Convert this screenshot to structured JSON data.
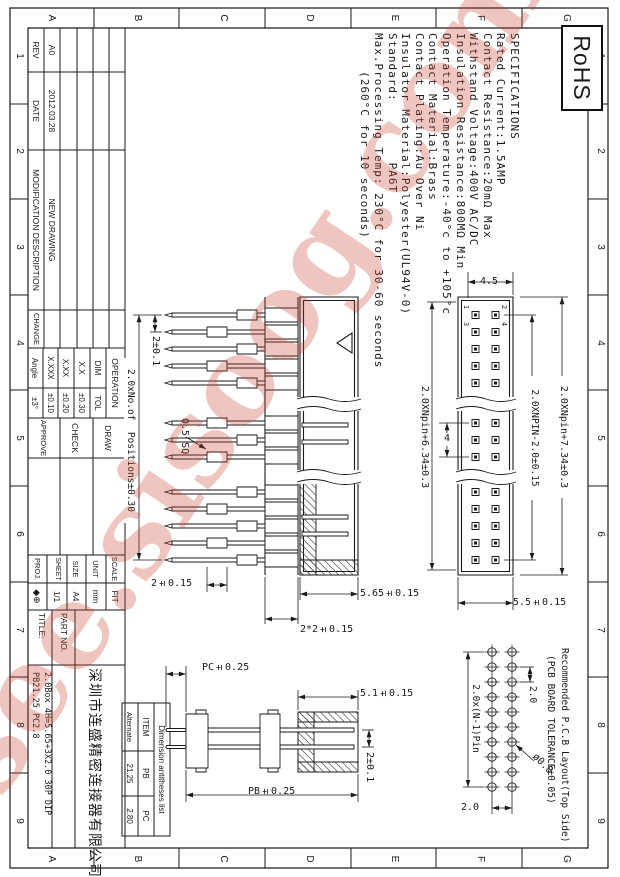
{
  "watermark": {
    "text": "isee.sisoog.com"
  },
  "rohs": {
    "label": "RoHS"
  },
  "frame": {
    "letters": [
      "G",
      "F",
      "E",
      "D",
      "C",
      "B",
      "A"
    ],
    "numbers": [
      "1",
      "2",
      "3",
      "4",
      "5",
      "6",
      "7",
      "8",
      "9"
    ]
  },
  "specs": {
    "lines": [
      "SPECIFICATIONS",
      "Rated Current:1.5AMP",
      "Contact Resistance:20mΩ Max",
      "Withstand Voltage:400V AC/DC",
      "Insulation Resistance:800MΩ Min",
      "Operation Temperature:-40°c to +105°c",
      "Contact Material:Brass",
      "Contact Plating:Au Over Ni",
      "Insulator Material:Polyester(UL94V-0)",
      "Standard:        PA6T",
      "Max.Processing Temp: 230°C for 30-60 seconds",
      "     (260°C for 10 seconds)"
    ]
  },
  "rev_table": {
    "headers": {
      "rev": "REV",
      "date": "DATE",
      "desc": "MODIFICATION  DESCRIPTION",
      "change": "CHANGE"
    },
    "row": {
      "rev": "A0",
      "date": "2012.03.28",
      "desc": "NEW  DRAWING"
    }
  },
  "tol_table": {
    "operation": "OPERATION",
    "dim": "DIM",
    "tol": "TOL",
    "rows": [
      {
        "d": "X.X",
        "t": "±0.30"
      },
      {
        "d": "X.XX",
        "t": "±0.20"
      },
      {
        "d": "X.XXX",
        "t": "±0.10"
      },
      {
        "d": "Angle",
        "t": "±3°"
      }
    ]
  },
  "signoff": {
    "draw": "DRAW",
    "check": "CHECK",
    "approve": "APPROVE"
  },
  "meta": {
    "scale_label": "SCALE",
    "scale_value": "FIT",
    "unit_label": "UNIT",
    "unit_value": "mm",
    "size_label": "SIZE",
    "size_value": "A4",
    "sheet_label": "SHEET",
    "sheet_value": "1/1",
    "proj_label": "PROJ.",
    "proj_value": "◆⊕"
  },
  "title_block": {
    "part_no_label": "PART NO.",
    "title_label": "TITLE:",
    "company": "深圳市连盛精密连接器有限公司",
    "line1": "2.0Box 4H=5.65+3X2.0 30P DIP",
    "line2": "PB21.25 PC2.8"
  },
  "front": {
    "pins": {
      "p1": "1",
      "p2": "2",
      "p3": "3",
      "p4": "4"
    },
    "dims": {
      "total": "2.0XNpin+7.34±0.3",
      "span": "2.0XNPIN-2.0±0.15",
      "height": "5.5±0.15",
      "wall": "4.5",
      "two_pitch": "4"
    }
  },
  "side": {
    "dims": {
      "inner": "2.0XNpin+6.34±0.3",
      "shroud": "5.65±0.15",
      "base": "2*2±0.15",
      "pitch": "2±0.1",
      "row_h": "2±0.15",
      "positions": "2.0xNo.of  Positions±0.30",
      "sq": "0.5 SQ"
    }
  },
  "pcb": {
    "title1": "Recommended P.C.B Layout(Top Side)",
    "title2": "(PCB BOARD TOLERANCE±0.05)",
    "dims": {
      "span": "2.0x(N-1)Pin",
      "pitch_top": "2.0",
      "pitch_right": "2.0",
      "hole": "ø0.8"
    }
  },
  "section": {
    "dims": {
      "pc": "PC±0.25",
      "depth": "5.1±0.15",
      "pb": "PB±0.25",
      "pitch": "2±0.1"
    }
  },
  "anti_table": {
    "title": "Dimension antitheses list",
    "h_item": "ITEM",
    "h_pb": "PB",
    "h_pc": "PC",
    "r_item": "Alternate",
    "r_pb": "21.25",
    "r_pc": "2.80"
  }
}
